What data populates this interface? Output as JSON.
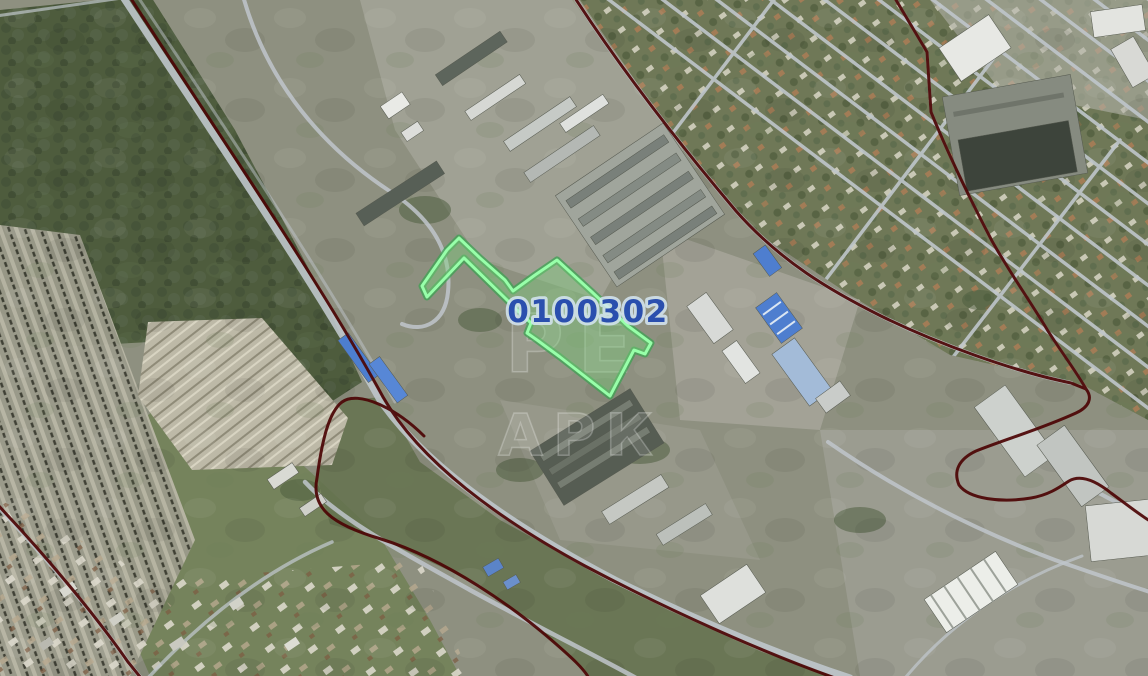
{
  "map": {
    "view": "satellite",
    "parcel": {
      "label": "0100302"
    },
    "watermark": {
      "line1": "РЕ",
      "line2": "АРК"
    },
    "colors": {
      "parcel_fill": "rgba(125,205,125,0.42)",
      "parcel_outline": "#97ffa9",
      "parcel_outline_shadow": "#3da153",
      "parcel_label": "#2a4fae",
      "parcel_label_halo": "#d5e6f2",
      "admin_boundary": "#4c0505",
      "road": "#bfc6cb"
    }
  }
}
